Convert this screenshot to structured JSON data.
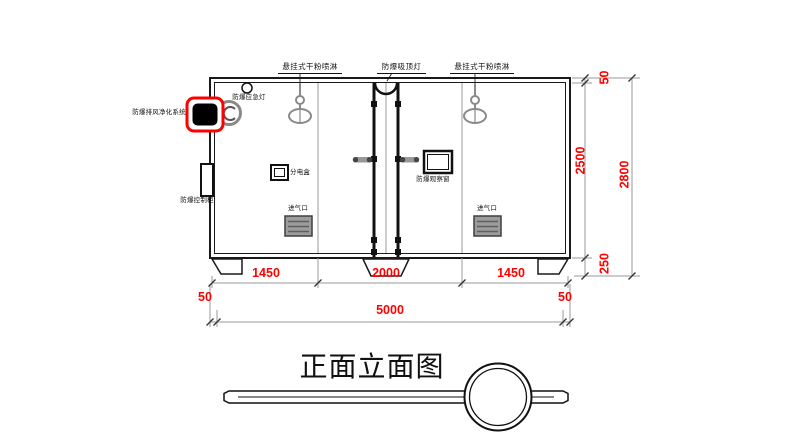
{
  "title": "正面立面图",
  "labels": {
    "sprinkler_left": "悬挂式干粉喷淋",
    "ceiling_lamp": "防爆吸顶灯",
    "sprinkler_right": "悬挂式干粉喷淋",
    "emergency_lamp": "防爆应急灯",
    "exhaust_purifier": "防爆排风净化系统",
    "control_cabinet": "防爆控制柜",
    "distribution_box": "分电盒",
    "observation_window": "防爆观察窗",
    "air_inlet_left": "进气口",
    "air_inlet_right": "进气口"
  },
  "dimensions": {
    "bay_left": "1450",
    "bay_center": "2000",
    "bay_right": "1450",
    "wall_left": "50",
    "wall_right": "50",
    "total_width": "5000",
    "roof": "50",
    "body_height": "2500",
    "base_height": "250",
    "total_height": "2800"
  },
  "colors": {
    "dimension_text": "#ff0000",
    "highlight_box": "#ff0000",
    "line": "#1a1a1a",
    "secondary_gray": "#8a8a8a"
  }
}
